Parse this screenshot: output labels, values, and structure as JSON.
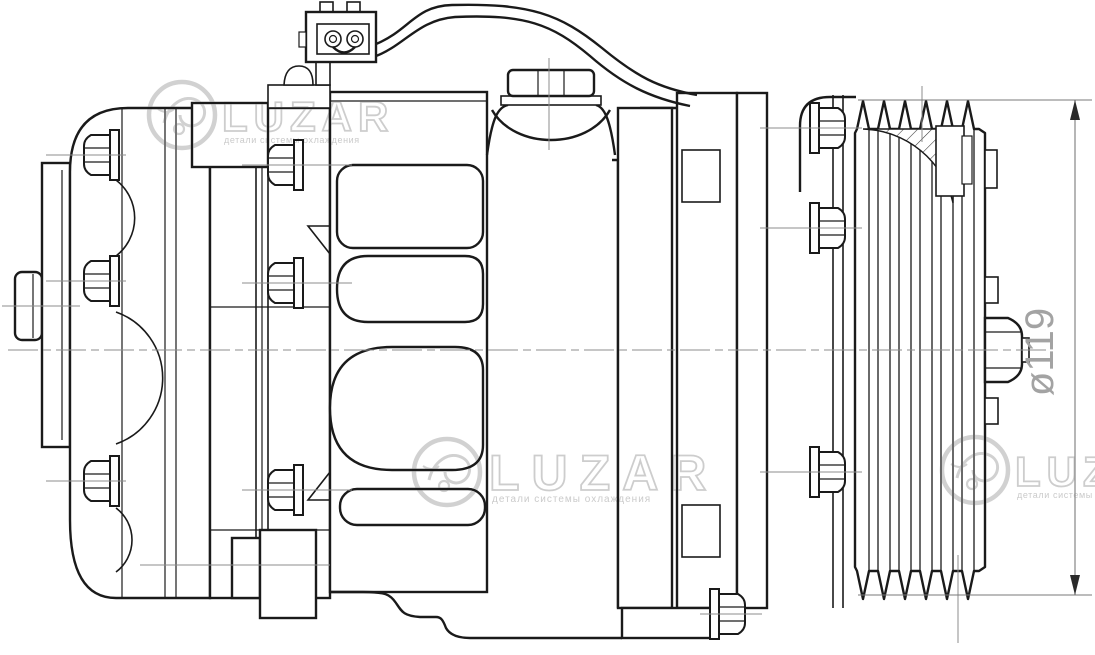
{
  "drawing": {
    "dimension_label": "ø119"
  },
  "watermark": {
    "brand": "LUZAR",
    "tagline": "детали системы охлаждения"
  },
  "colors": {
    "background": "#ffffff",
    "line": "#1a1a1a",
    "centerline": "#8c8c8c",
    "dimension_line": "#7a7a7a",
    "dimension_text": "#a3a3a3",
    "watermark": "#c9c9c9"
  }
}
